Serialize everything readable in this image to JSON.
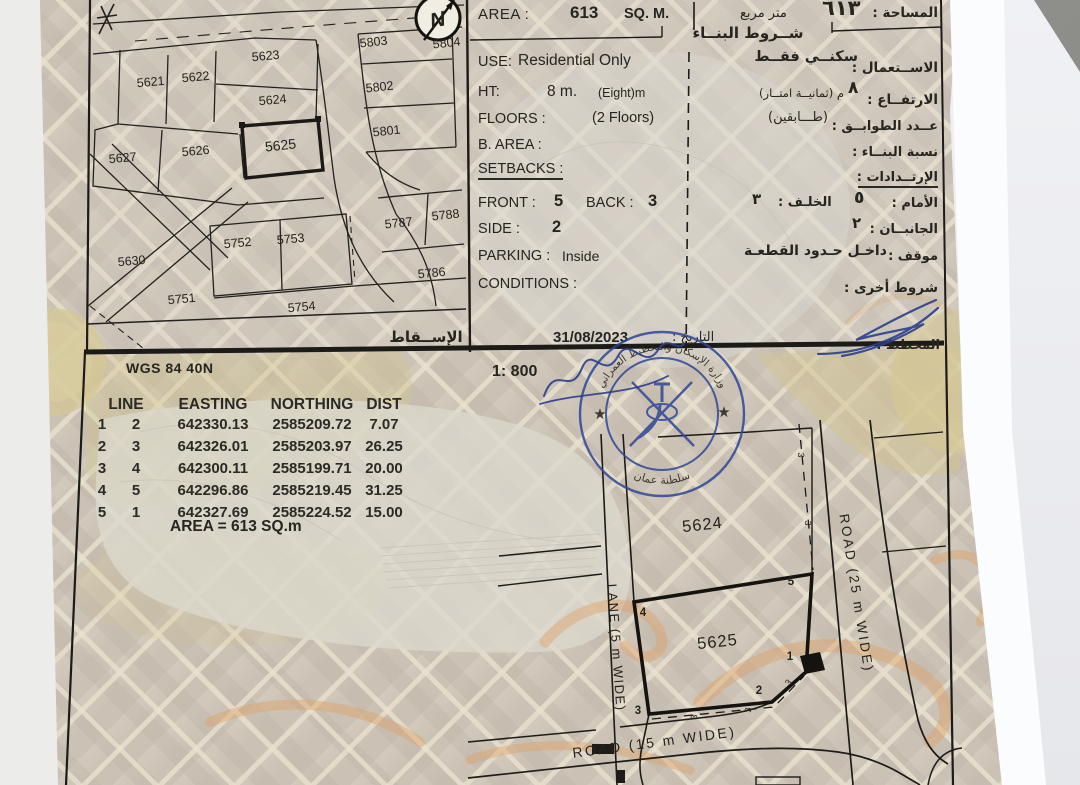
{
  "photo": {
    "background": "#9a9a98",
    "paper_white": "#f2f3f5",
    "document_base": "#d2cabc",
    "ink": "#23221e",
    "stamp_blue": "#2e4796",
    "calligraphy_orange": "#dd9f62",
    "olive": "#d2c48f"
  },
  "map": {
    "plots": [
      "5621",
      "5622",
      "5623",
      "5624",
      "5625",
      "5626",
      "5627",
      "5630",
      "5751",
      "5752",
      "5753",
      "5754",
      "5786",
      "5787",
      "5788",
      "5801",
      "5802",
      "5803",
      "5804"
    ],
    "subject_plot": "5625",
    "north_label": "N",
    "projection_label_ar": "الإســقاط"
  },
  "info": {
    "area": {
      "label_en": "AREA :",
      "value": "613",
      "unit_en": "SQ. M.",
      "unit_ar": "متر مربع",
      "value_ar": "٦١٣",
      "label_ar": "المساحة :"
    },
    "header_ar": "شــروط البنــاء",
    "use": {
      "label_en": "USE:",
      "value_en": "Residential Only",
      "value_ar": "سكنــي فقــط",
      "label_ar": "الاســتعمال :"
    },
    "height": {
      "label_en": "HT:",
      "value_en": "8 m.",
      "note_en": "(Eight)m",
      "value_ar": "٨",
      "note_ar": "م  (ثمانيــة امتــار)",
      "label_ar": "الارتفــاع :"
    },
    "floors": {
      "label_en": "FLOORS :",
      "value_en": "(2 Floors)",
      "value_ar": "(طـــابقين)",
      "label_ar": "عــدد الطوابــق :"
    },
    "b_area": {
      "label_en": "B. AREA :",
      "label_ar": "نسبة البنــاء :"
    },
    "setbacks": {
      "label_en": "SETBACKS :",
      "label_ar": "الإرتــدادات :"
    },
    "front": {
      "label_en": "FRONT :",
      "value": "5",
      "value_ar": "٥",
      "label_ar": "الأمام :"
    },
    "back": {
      "label_en": "BACK :",
      "value": "3",
      "value_ar": "٣",
      "label_ar": "الخلـف :"
    },
    "side": {
      "label_en": "SIDE :",
      "value": "2",
      "value_ar": "٢",
      "label_ar": "الجانبــان :"
    },
    "parking": {
      "label_en": "PARKING :",
      "value_en": "Inside",
      "value_ar": "داخـل حـدود القطعـة",
      "label_ar": "موقف :"
    },
    "conditions": {
      "label_en": "CONDITIONS :",
      "label_ar": "شروط أخرى :"
    },
    "date": "31/08/2023",
    "date_label_ar": "التاريخ :",
    "planner_label_ar": "المخطط :"
  },
  "survey": {
    "datum": "WGS 84  40N",
    "scale": "1: 800",
    "table": {
      "headers": [
        "LINE",
        "EASTING",
        "NORTHING",
        "DIST"
      ],
      "rows": [
        {
          "from": "1",
          "to": "2",
          "easting": "642330.13",
          "northing": "2585209.72",
          "dist": "7.07"
        },
        {
          "from": "2",
          "to": "3",
          "easting": "642326.01",
          "northing": "2585203.97",
          "dist": "26.25"
        },
        {
          "from": "3",
          "to": "4",
          "easting": "642300.11",
          "northing": "2585199.71",
          "dist": "20.00"
        },
        {
          "from": "4",
          "to": "5",
          "easting": "642296.86",
          "northing": "2585219.45",
          "dist": "31.25"
        },
        {
          "from": "5",
          "to": "1",
          "easting": "642327.69",
          "northing": "2585224.52",
          "dist": "15.00"
        }
      ],
      "area_line": "AREA = 613  SQ.m"
    },
    "drawing": {
      "plot_a": "5624",
      "plot_b": "5625",
      "corners": [
        "1",
        "2",
        "3",
        "4",
        "5"
      ],
      "setback_mark": "3",
      "lane_label": "LANE (5 m WIDE)",
      "road_east_label": "ROAD (25 m WIDE)",
      "road_south_label": "ROAD (15 m WIDE)"
    },
    "stamp": {
      "arc_top_ar": "وزارة الإسكان والتخطيط العمراني",
      "arc_bottom_ar": "سلطنة عمان",
      "star": "★"
    }
  }
}
